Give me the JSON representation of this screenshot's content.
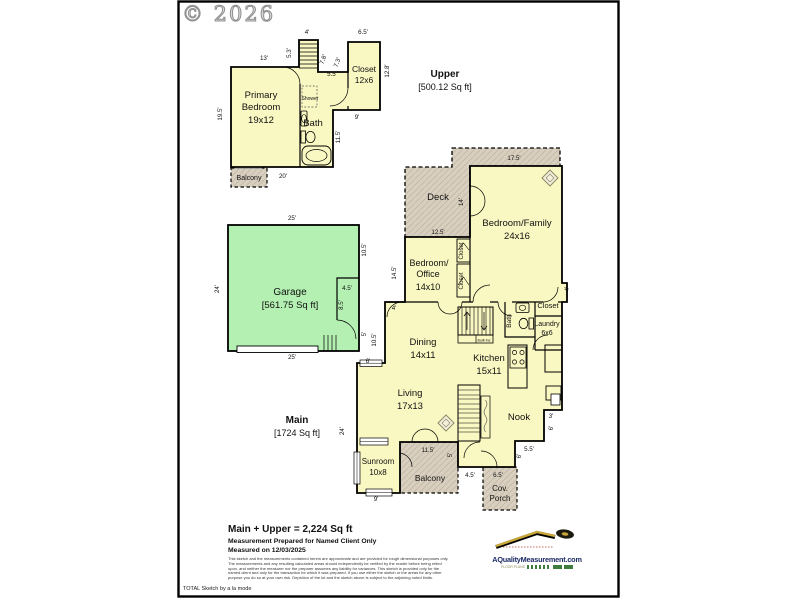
{
  "copyright": "© 2026",
  "footer_note": "TOTAL Sketch by a la mode",
  "summary": {
    "total": "Main + Upper = 2,224 Sq ft",
    "prepared": "Measurement Prepared for Named Client Only",
    "measured": "Measured on 12/03/2025",
    "disclaimer_lines": [
      "This sketch and the measurements contained herein are approximate and are provided for rough dimensional purposes only.",
      "The measurements and any resulting calculated areas should independently be verified by the reader before being relied",
      "upon, and neither the measurer nor the preparer assumes any liability for variances. This sketch is provided only for the",
      "named client and only for the transaction for which it was prepared. If you use either the sketch or the areas for any other",
      "purpose you do so at your own risk. Depiction of the lot and the sketch above is subject to the adjoining noted limits."
    ]
  },
  "logo": {
    "site": "AQualityMeasurement.com",
    "tagline": "FLOOR PLANS"
  },
  "colors": {
    "floor_fill": "#FAF8C2",
    "garage_fill": "#B4F0B2",
    "outdoor_fill": "#D8CFC0",
    "logo_navy": "#1c2a66",
    "logo_gold": "#c9a63a",
    "logo_green": "#3f7d3f"
  },
  "floors": {
    "upper": {
      "name": "Upper",
      "area": "[500.12 Sq ft]"
    },
    "main": {
      "name": "Main",
      "area": "[1724 Sq ft]"
    },
    "garage": {
      "name": "Garage",
      "area": "[561.75 Sq ft]"
    }
  },
  "plan_labels": [
    {
      "x": 261,
      "y": 98,
      "t": "Primary"
    },
    {
      "x": 261,
      "y": 110,
      "t": "Bedroom"
    },
    {
      "x": 261,
      "y": 123,
      "t": "19x12"
    },
    {
      "x": 313,
      "y": 126,
      "t": "Bath"
    },
    {
      "x": 310,
      "y": 100,
      "t": "Shower",
      "s": 5
    },
    {
      "x": 364,
      "y": 72,
      "t": "Closet",
      "s": 8.5
    },
    {
      "x": 364,
      "y": 83,
      "t": "12x6",
      "s": 8.5
    },
    {
      "x": 249,
      "y": 180,
      "t": "Balcony",
      "s": 7
    },
    {
      "x": 445,
      "y": 77,
      "t": "Upper",
      "s": 10,
      "b": 1
    },
    {
      "x": 445,
      "y": 90,
      "t": "[500.12 Sq ft]",
      "s": 9
    },
    {
      "x": 290,
      "y": 295,
      "t": "Garage",
      "s": 10
    },
    {
      "x": 290,
      "y": 308,
      "t": "[561.75 Sq ft]",
      "s": 9.5
    },
    {
      "x": 438,
      "y": 200,
      "t": "Deck"
    },
    {
      "x": 517,
      "y": 226,
      "t": "Bedroom/Family"
    },
    {
      "x": 517,
      "y": 239,
      "t": "24x16"
    },
    {
      "x": 429,
      "y": 266,
      "t": "Bedroom/",
      "s": 9
    },
    {
      "x": 428,
      "y": 277,
      "t": "Office",
      "s": 9
    },
    {
      "x": 428,
      "y": 290,
      "t": "14x10",
      "s": 9
    },
    {
      "x": 463,
      "y": 251,
      "t": "Closet",
      "s": 6,
      "r": -90
    },
    {
      "x": 463,
      "y": 281,
      "t": "Closet",
      "s": 6,
      "r": -90
    },
    {
      "x": 423,
      "y": 345,
      "t": "Dining"
    },
    {
      "x": 423,
      "y": 358,
      "t": "14x11"
    },
    {
      "x": 489,
      "y": 361,
      "t": "Kitchen"
    },
    {
      "x": 489,
      "y": 374,
      "t": "15x11"
    },
    {
      "x": 511,
      "y": 321,
      "t": "Bath",
      "s": 6.5,
      "r": -90
    },
    {
      "x": 548,
      "y": 308,
      "t": "Closet",
      "s": 7.5
    },
    {
      "x": 547,
      "y": 326,
      "t": "Laundry",
      "s": 7
    },
    {
      "x": 547,
      "y": 335,
      "t": "6x6",
      "s": 7
    },
    {
      "x": 410,
      "y": 396,
      "t": "Living"
    },
    {
      "x": 410,
      "y": 409,
      "t": "17x13"
    },
    {
      "x": 519,
      "y": 420,
      "t": "Nook"
    },
    {
      "x": 378,
      "y": 464,
      "t": "Sunroom",
      "s": 8
    },
    {
      "x": 378,
      "y": 475,
      "t": "10x8",
      "s": 8
    },
    {
      "x": 430,
      "y": 481,
      "t": "Balcony",
      "s": 8.5
    },
    {
      "x": 500,
      "y": 491,
      "t": "Cov.",
      "s": 8
    },
    {
      "x": 500,
      "y": 501,
      "t": "Porch",
      "s": 8
    },
    {
      "x": 484,
      "y": 341.5,
      "t": "Built-Ins",
      "s": 3.6
    },
    {
      "x": 297,
      "y": 423,
      "t": "Main",
      "s": 10,
      "b": 1
    },
    {
      "x": 297,
      "y": 436,
      "t": "[1724 Sq ft]",
      "s": 9
    }
  ],
  "dim_labels": [
    {
      "x": 307,
      "y": 34,
      "t": "4'"
    },
    {
      "x": 264,
      "y": 60,
      "t": "13'"
    },
    {
      "x": 363,
      "y": 34,
      "t": "6.5'"
    },
    {
      "x": 291,
      "y": 53,
      "t": "5.3'",
      "r": -90
    },
    {
      "x": 325,
      "y": 60,
      "t": "7.8'",
      "r": -70
    },
    {
      "x": 339,
      "y": 63,
      "t": "7.3'",
      "r": -70
    },
    {
      "x": 332,
      "y": 76,
      "t": "5.5'"
    },
    {
      "x": 389,
      "y": 71,
      "t": "12.8'",
      "r": -90
    },
    {
      "x": 222,
      "y": 114,
      "t": "19.5'",
      "r": -90
    },
    {
      "x": 357,
      "y": 119,
      "t": "9'"
    },
    {
      "x": 340,
      "y": 137,
      "t": "11.5'",
      "r": -90
    },
    {
      "x": 283,
      "y": 178,
      "t": "20'"
    },
    {
      "x": 292,
      "y": 220,
      "t": "25'"
    },
    {
      "x": 219,
      "y": 289,
      "t": "24'",
      "r": -90
    },
    {
      "x": 366,
      "y": 250,
      "t": "10.5'",
      "r": -90
    },
    {
      "x": 347,
      "y": 290,
      "t": "4.5'"
    },
    {
      "x": 343,
      "y": 305,
      "t": "8.5'",
      "r": -90
    },
    {
      "x": 366,
      "y": 334,
      "t": "5'",
      "r": -90
    },
    {
      "x": 376,
      "y": 340,
      "t": "10.5'",
      "r": -90
    },
    {
      "x": 368,
      "y": 363,
      "t": "6'"
    },
    {
      "x": 292,
      "y": 359,
      "t": "25'"
    },
    {
      "x": 514,
      "y": 160,
      "t": "17.5'"
    },
    {
      "x": 463,
      "y": 202,
      "t": "14'",
      "r": -90
    },
    {
      "x": 438,
      "y": 234,
      "t": "12.5'"
    },
    {
      "x": 396,
      "y": 273,
      "t": "14.5'",
      "r": -90
    },
    {
      "x": 394,
      "y": 310,
      "t": "4'"
    },
    {
      "x": 569,
      "y": 289,
      "t": "4'",
      "r": -90
    },
    {
      "x": 344,
      "y": 431,
      "t": "24'",
      "r": -90
    },
    {
      "x": 376,
      "y": 501,
      "t": "9'"
    },
    {
      "x": 428,
      "y": 452,
      "t": "11.5'"
    },
    {
      "x": 452,
      "y": 455,
      "t": "5'",
      "r": -90
    },
    {
      "x": 470,
      "y": 477,
      "t": "4.5'"
    },
    {
      "x": 498,
      "y": 477,
      "t": "6.5'"
    },
    {
      "x": 529,
      "y": 451,
      "t": "5.5'"
    },
    {
      "x": 521,
      "y": 456,
      "t": "6'",
      "r": -90
    },
    {
      "x": 551,
      "y": 418,
      "t": "3'"
    },
    {
      "x": 553,
      "y": 428,
      "t": "6'",
      "r": -90
    }
  ]
}
